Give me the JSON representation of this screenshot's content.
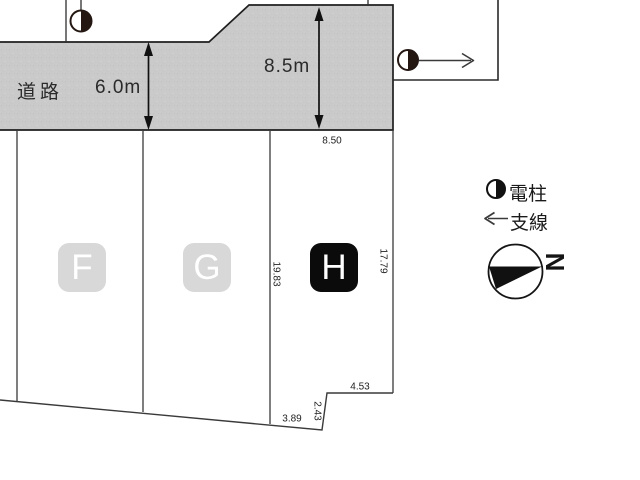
{
  "road": {
    "label": "道路",
    "width_dim": "6.0m",
    "depth_dim": "8.5m"
  },
  "plots": {
    "f_label": "F",
    "g_label": "G",
    "h_label": "H"
  },
  "dimensions": {
    "frontage": "8.50",
    "west_side": "19.83",
    "east_side": "17.79",
    "step_top": "4.53",
    "step_side": "2.43",
    "rear": "3.89"
  },
  "legend": {
    "utility_pole": "電柱",
    "guy_wire": "支線",
    "north": "N"
  },
  "colors": {
    "road_fill": "#cacaca",
    "boundary_line": "#2e2e2e",
    "plot_badge_light_bg": "#d8d8d8",
    "plot_badge_dark_bg": "#0b0b0b",
    "badge_text": "#ffffff",
    "text": "#1e1e1e"
  }
}
